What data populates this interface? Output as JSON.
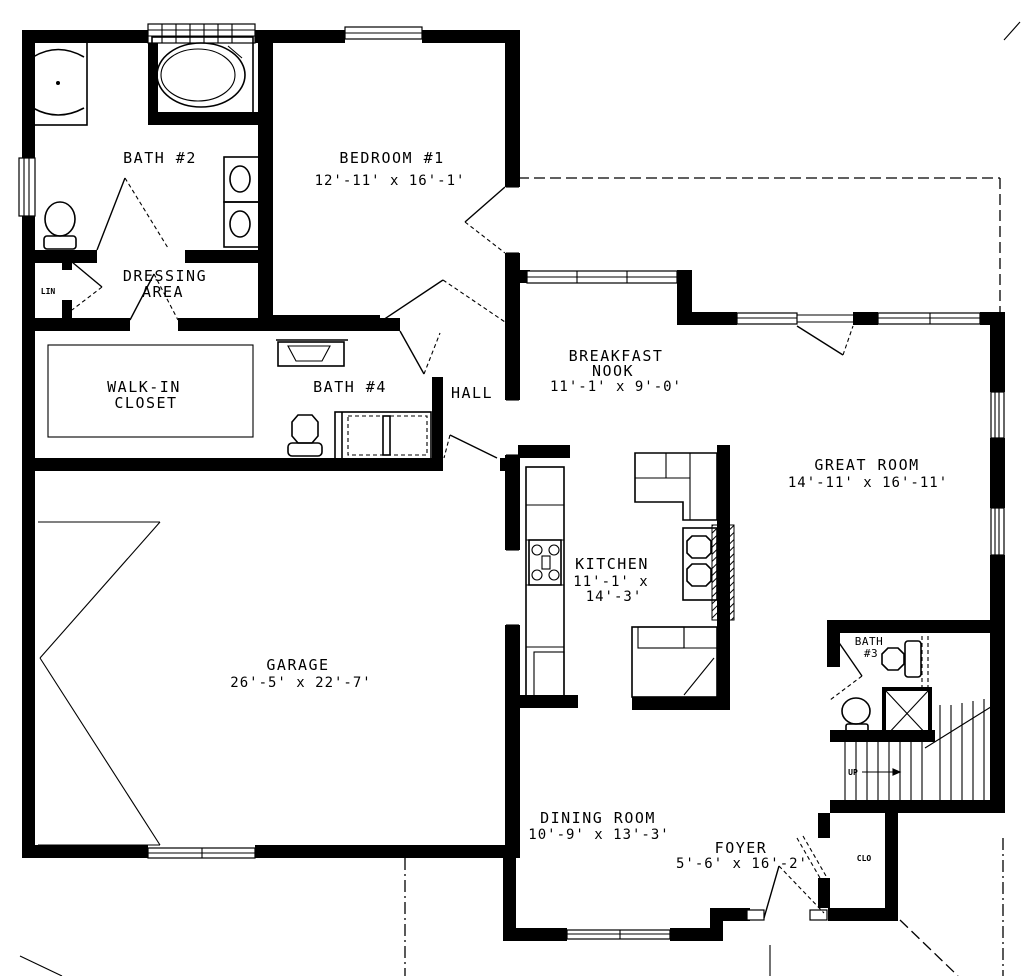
{
  "colors": {
    "wall": "#000000",
    "background": "#ffffff"
  },
  "rooms": {
    "bath2": {
      "label": "BATH #2"
    },
    "bedroom1": {
      "label": "BEDROOM #1",
      "dims": "12'-11' x 16'-1'"
    },
    "dressing": {
      "label1": "DRESSING",
      "label2": "AREA"
    },
    "lin": {
      "label": "LIN"
    },
    "walkin": {
      "label1": "WALK-IN",
      "label2": "CLOSET"
    },
    "bath4": {
      "label": "BATH #4"
    },
    "hall": {
      "label": "HALL"
    },
    "nook": {
      "label1": "BREAKFAST",
      "label2": "NOOK",
      "dims": "11'-1' x 9'-0'"
    },
    "great": {
      "label": "GREAT ROOM",
      "dims": "14'-11' x 16'-11'"
    },
    "kitchen": {
      "label": "KITCHEN",
      "dims1": "11'-1' x",
      "dims2": "14'-3'"
    },
    "garage": {
      "label": "GARAGE",
      "dims": "26'-5' x 22'-7'"
    },
    "bath3": {
      "label1": "BATH",
      "label2": "#3"
    },
    "dining": {
      "label": "DINING ROOM",
      "dims": "10'-9' x 13'-3'"
    },
    "foyer": {
      "label": "FOYER",
      "dims": "5'-6' x 16'-2'"
    },
    "clo": {
      "label": "CLO"
    },
    "stairs": {
      "label": "UP"
    }
  }
}
